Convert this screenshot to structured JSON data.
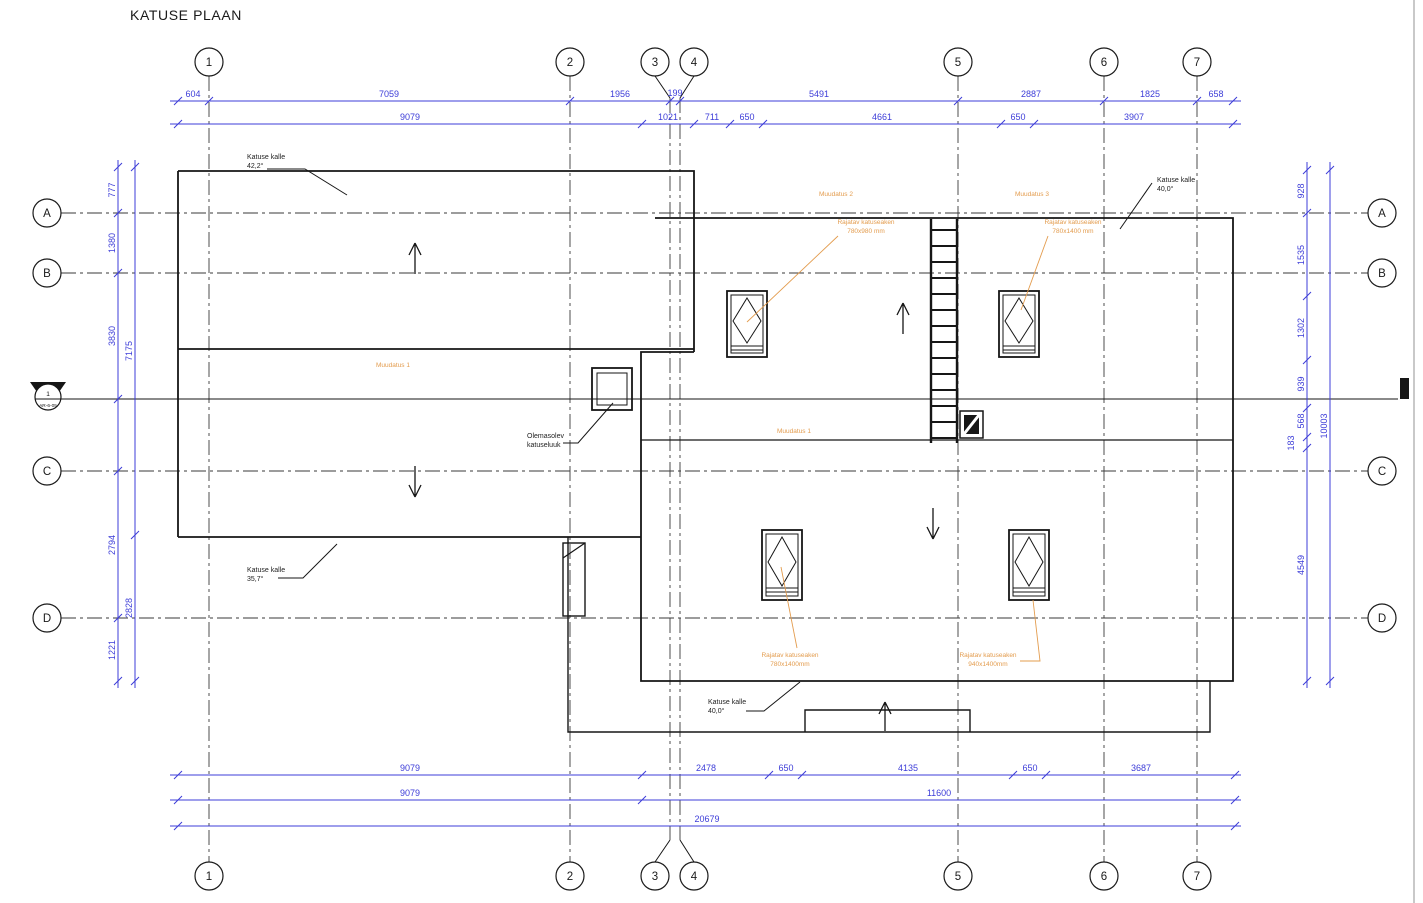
{
  "title": "KATUSE PLAAN",
  "colors": {
    "dimension_blue": "#3d3dd8",
    "revision_orange": "#e39c4e",
    "drawing_black": "#161616"
  },
  "grid": {
    "columns": [
      "1",
      "2",
      "3",
      "4",
      "5",
      "6",
      "7"
    ],
    "rows": [
      "A",
      "B",
      "C",
      "D"
    ]
  },
  "section_marker": {
    "number": "1",
    "sheet_ref": "AR-6-05"
  },
  "dimensions": {
    "top_row1": [
      "604",
      "7059",
      "1956",
      "199",
      "5491",
      "2887",
      "1825",
      "658"
    ],
    "top_row2": [
      "9079",
      "1021",
      "711",
      "650",
      "4661",
      "650",
      "3907"
    ],
    "bottom_row1": [
      "9079",
      "2478",
      "650",
      "4135",
      "650",
      "3687"
    ],
    "bottom_row2": [
      "9079",
      "11600"
    ],
    "bottom_row3": [
      "20679"
    ],
    "left_inner": [
      "777",
      "1380",
      "3830",
      "2794",
      "1221"
    ],
    "left_outer": [
      "7175",
      "2828"
    ],
    "right_inner": [
      "928",
      "1535",
      "1302",
      "939",
      "568",
      "183",
      "4549"
    ],
    "right_outer": [
      "10003"
    ]
  },
  "annotations": {
    "slope_nw": {
      "label": "Katuse kalle",
      "value": "42,2°"
    },
    "slope_ne": {
      "label": "Katuse kalle",
      "value": "40,0°"
    },
    "slope_sw": {
      "label": "Katuse kalle",
      "value": "35,7°"
    },
    "slope_s": {
      "label": "Katuse kalle",
      "value": "40,0°"
    },
    "existing_hatch": {
      "line1": "Olemasolev",
      "line2": "katuseluuk"
    },
    "revisions": {
      "muudatus_left": "Muudatus 1",
      "muudatus_2": "Muudatus 2",
      "muudatus_3": "Muudatus 3",
      "muudatus_right": "Muudatus 1"
    },
    "skylights": {
      "sk1": {
        "line1": "Rajatav katuseaken",
        "line2": "780x980 mm"
      },
      "sk2": {
        "line1": "Rajatav katuseaken",
        "line2": "780x1400 mm"
      },
      "sk3": {
        "line1": "Rajatav katuseaken",
        "line2": "780x1400mm"
      },
      "sk4": {
        "line1": "Rajatav katuseaken",
        "line2": "940x1400mm"
      }
    }
  }
}
